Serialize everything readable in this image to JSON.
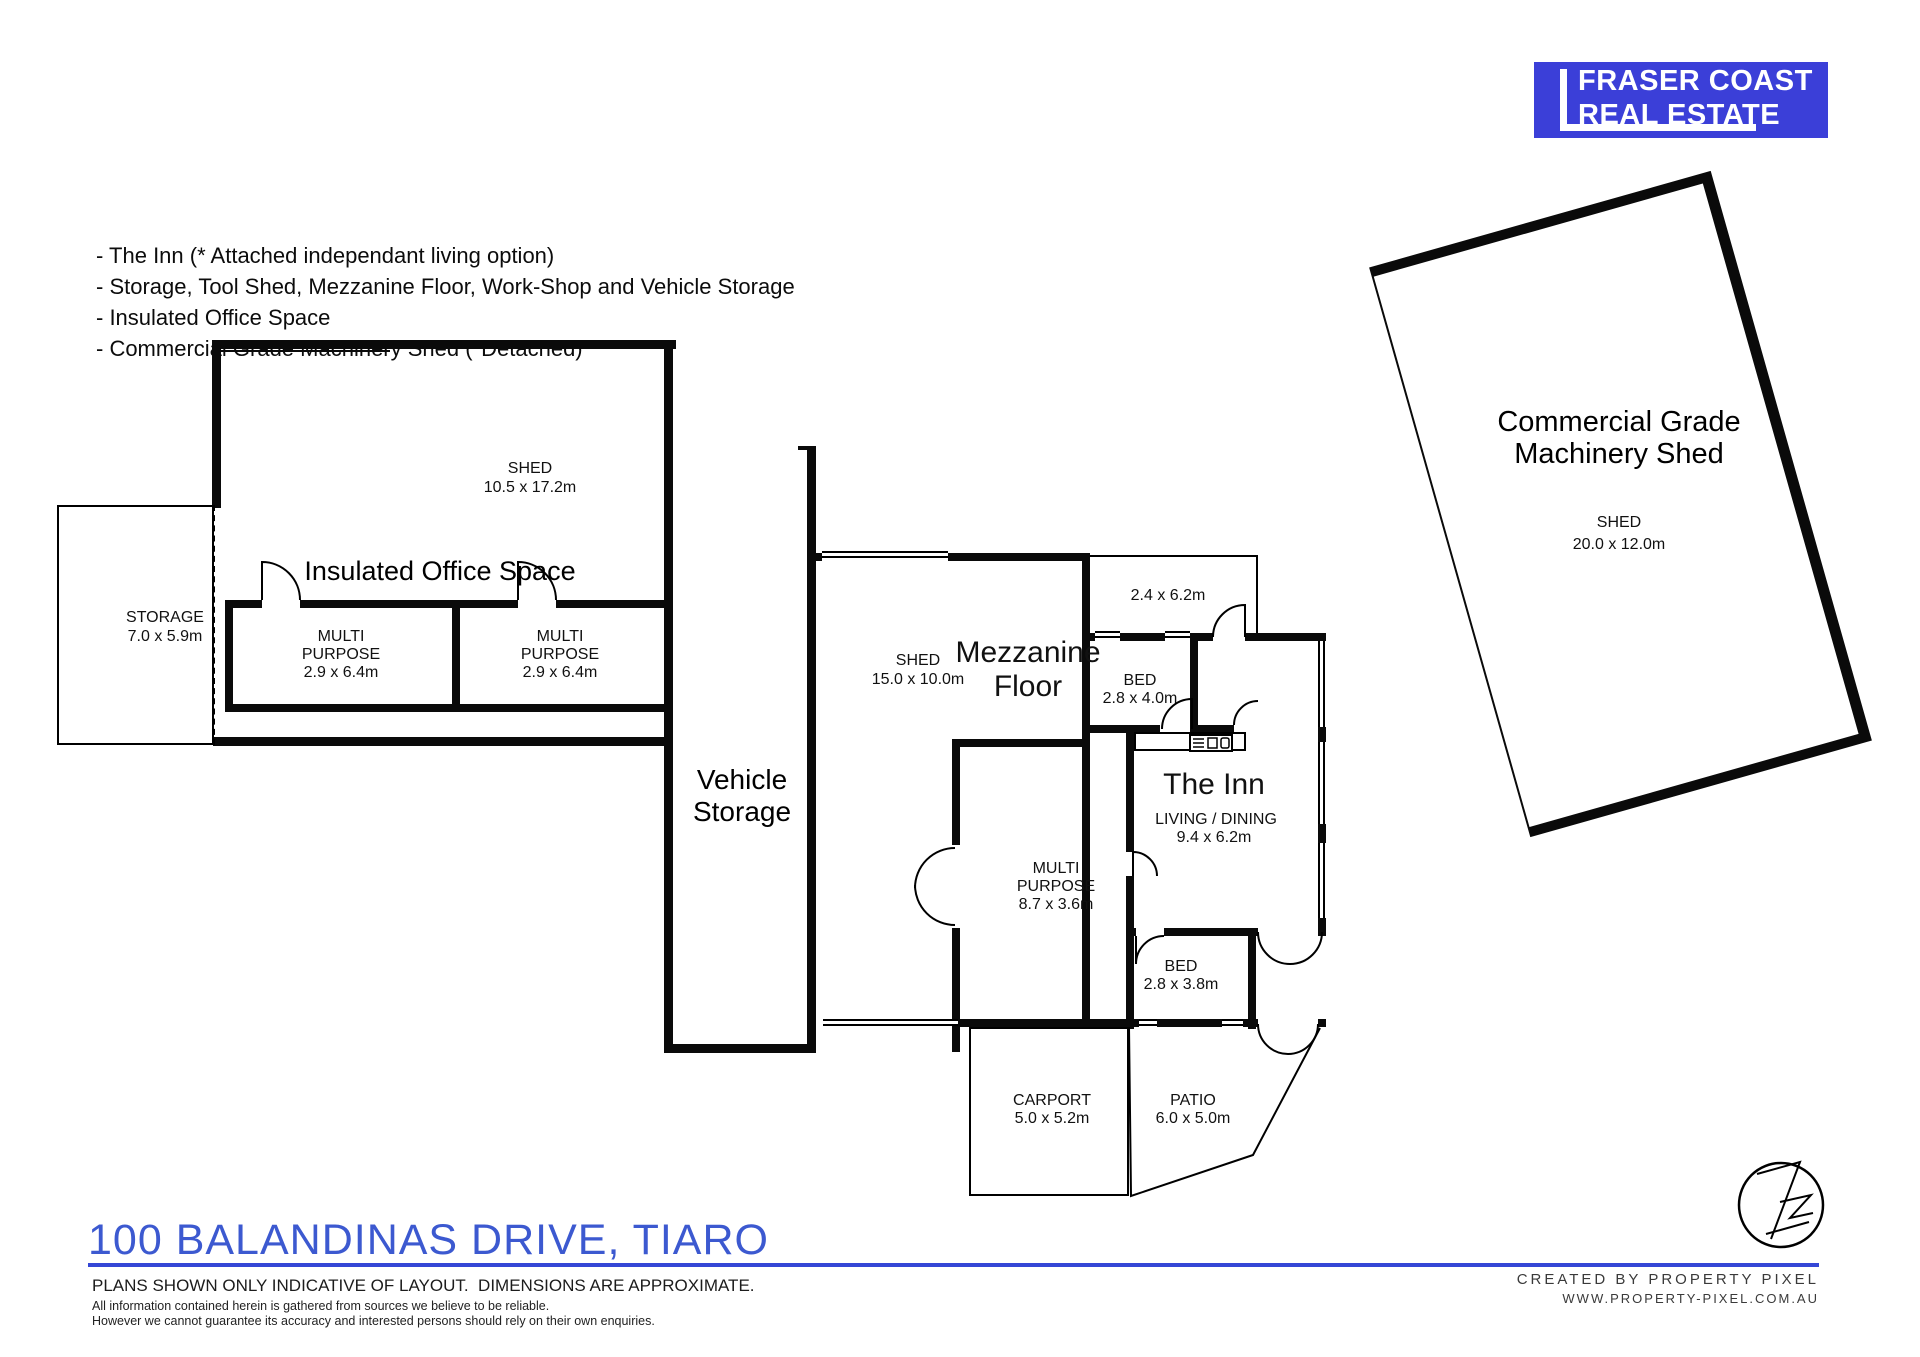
{
  "logo": {
    "line1": "FRASER COAST",
    "line2": "REAL ESTATE"
  },
  "features": [
    "- The Inn (* Attached independant living option)",
    "- Storage, Tool Shed, Mezzanine Floor, Work-Shop and Vehicle Storage",
    "- Insulated Office Space",
    "- Commercial Grade Machinery Shed (*Detached)"
  ],
  "plan": {
    "left_building": {
      "shed": {
        "name": "SHED",
        "dims": "10.5 x 17.2m"
      },
      "storage": {
        "name": "STORAGE",
        "dims": "7.0 x 5.9m"
      },
      "office_title": "Insulated Office Space",
      "multi1": {
        "l1": "MULTI",
        "l2": "PURPOSE",
        "dims": "2.9 x 6.4m"
      },
      "multi2": {
        "l1": "MULTI",
        "l2": "PURPOSE",
        "dims": "2.9 x 6.4m"
      },
      "vehicle_storage": {
        "l1": "Vehicle",
        "l2": "Storage"
      }
    },
    "middle_building": {
      "shed": {
        "name": "SHED",
        "dims": "15.0 x 10.0m"
      },
      "mezzanine": {
        "l1": "Mezzanine",
        "l2": "Floor"
      },
      "room24": {
        "dims": "2.4 x 6.2m"
      },
      "bed1": {
        "name": "BED",
        "dims": "2.8 x 4.0m"
      },
      "inn": {
        "title": "The Inn",
        "living": "LIVING / DINING",
        "living_dims": "9.4 x 6.2m"
      },
      "multi87": {
        "l1": "MULTI",
        "l2": "PURPOSE",
        "dims": "8.7 x 3.6m"
      },
      "bed2": {
        "name": "BED",
        "dims": "2.8 x 3.8m"
      },
      "carport": {
        "name": "CARPORT",
        "dims": "5.0 x 5.2m"
      },
      "patio": {
        "name": "PATIO",
        "dims": "6.0 x 5.0m"
      }
    },
    "machinery_shed": {
      "title1": "Commercial Grade",
      "title2": "Machinery Shed",
      "name": "SHED",
      "dims": "20.0 x 12.0m"
    }
  },
  "footer": {
    "address": "100 BALANDINAS DRIVE, TIARO",
    "disclaimer": "PLANS SHOWN ONLY INDICATIVE OF LAYOUT.  DIMENSIONS ARE APPROXIMATE.",
    "fine1": "All information contained herein is gathered from sources we believe to be reliable.",
    "fine2": "However we cannot guarantee its accuracy and interested persons should rely on their own enquiries.",
    "credit1": "CREATED BY PROPERTY PIXEL",
    "credit2": "WWW.PROPERTY-PIXEL.COM.AU"
  },
  "colors": {
    "brand_blue": "#3b3fd8",
    "title_blue": "#3c59d0",
    "rule_blue": "#3547d6",
    "wall": "#0a0a0a"
  }
}
